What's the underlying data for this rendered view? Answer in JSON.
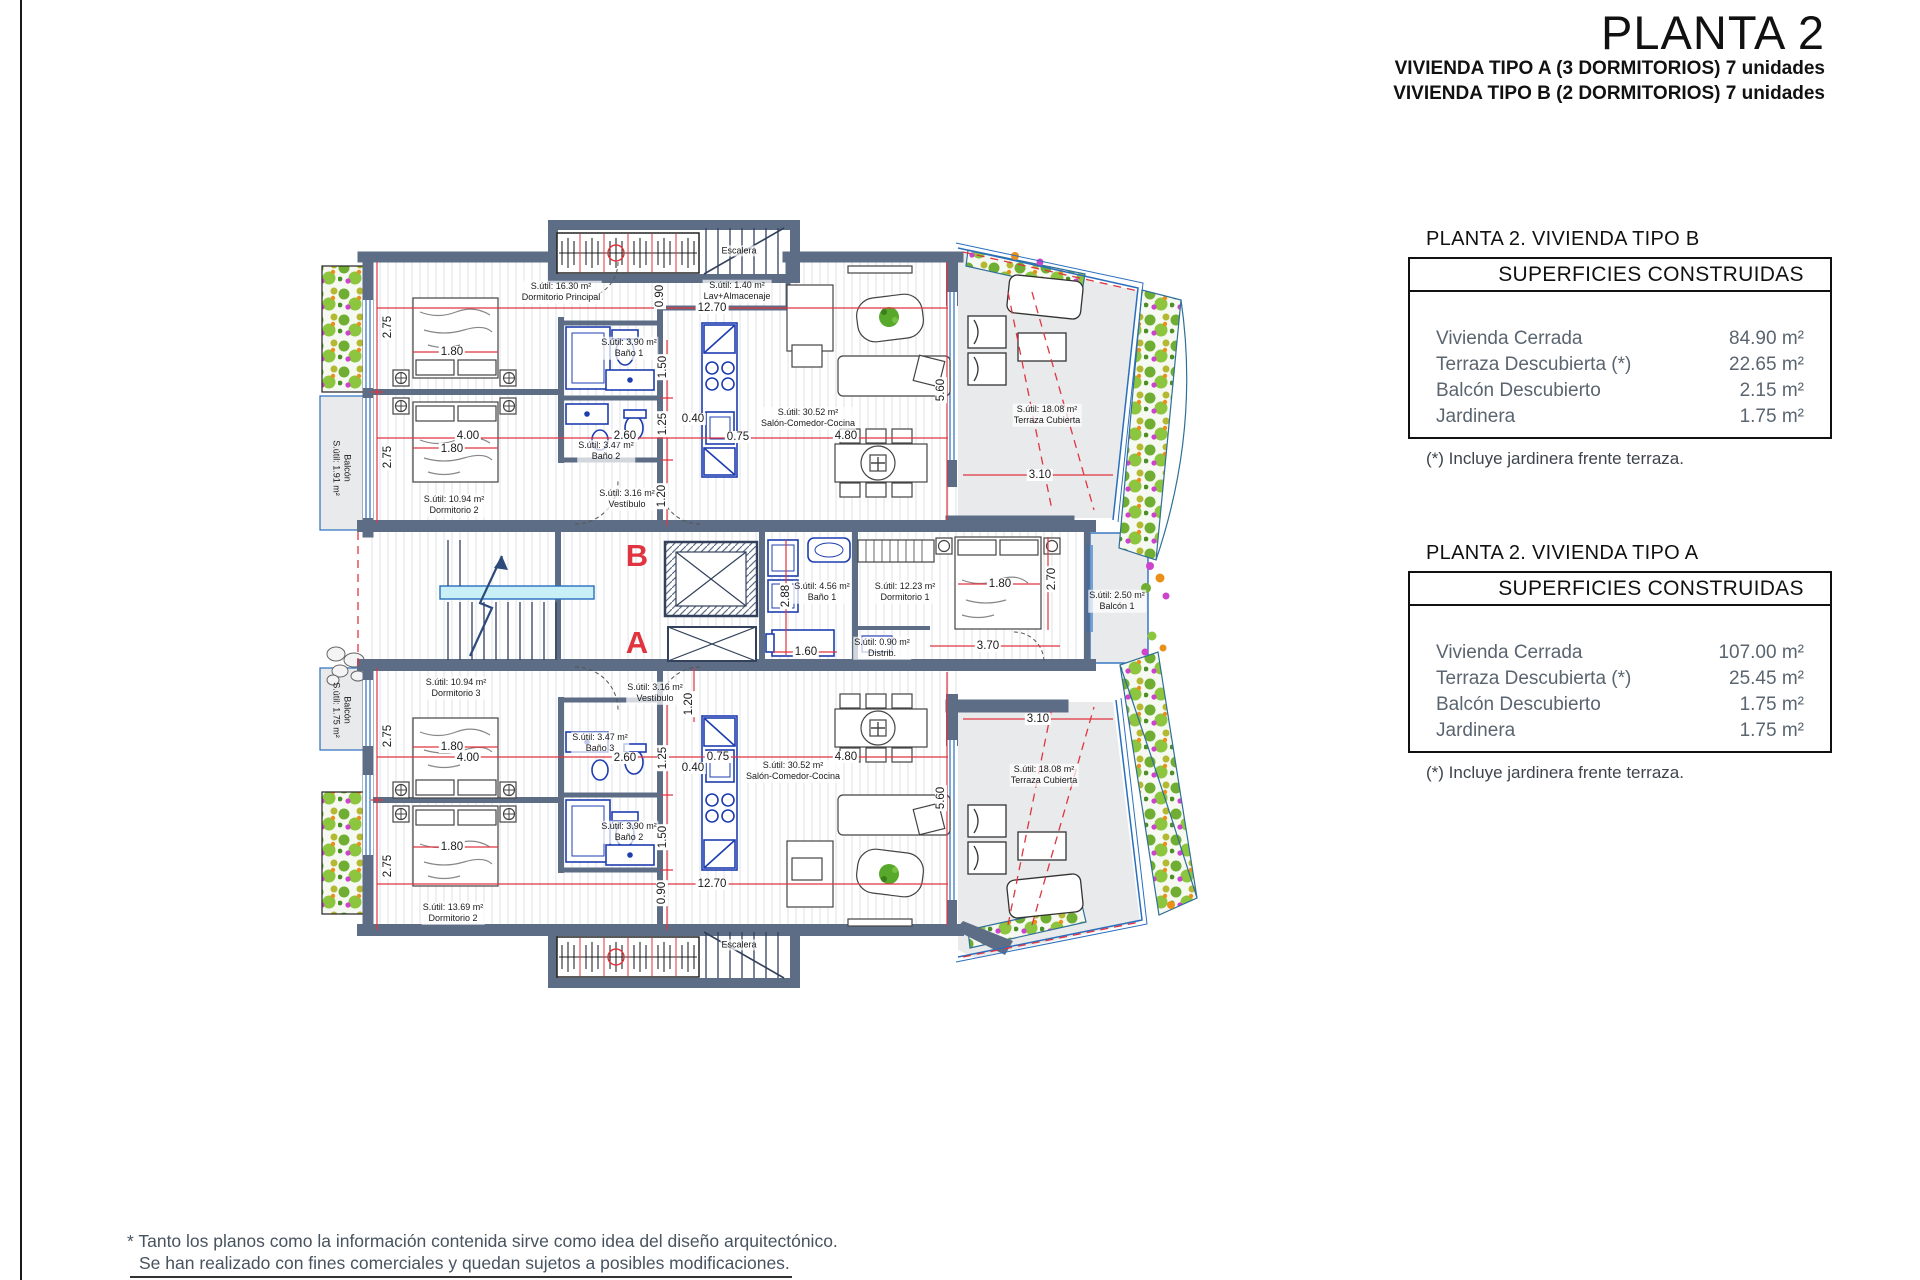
{
  "colors": {
    "wall": "#5e6d86",
    "dim_red": "#e03540",
    "fixture_blue": "#1d3db0",
    "glass_blue": "#2a6fbd",
    "terrace_gray": "#e9eaec",
    "plant_green": "#6fae32",
    "letter_red": "#e03540"
  },
  "page": {
    "title": "PLANTA 2",
    "subtitle_line1": "VIVIENDA TIPO A (3 DORMITORIOS) 7 unidades",
    "subtitle_line2": "VIVIENDA TIPO B (2 DORMITORIOS) 7 unidades",
    "disclaimer_line1": "* Tanto los planos como la información contenida sirve como idea del diseño arquitectónico.",
    "disclaimer_line2": "Se han realizado con fines comerciales y quedan sujetos a posibles modificaciones."
  },
  "panels": [
    {
      "heading": "PLANTA 2. VIVIENDA TIPO B",
      "table_title": "SUPERFICIES CONSTRUIDAS",
      "rows": [
        {
          "label": "Vivienda Cerrada",
          "value": "84.90 m²"
        },
        {
          "label": "Terraza Descubierta (*)",
          "value": "22.65 m²"
        },
        {
          "label": "Balcón Descubierto",
          "value": "2.15 m²"
        },
        {
          "label": "Jardinera",
          "value": "1.75 m²"
        }
      ],
      "footnote": "(*) Incluye jardinera frente terraza."
    },
    {
      "heading": "PLANTA 2. VIVIENDA TIPO A",
      "table_title": "SUPERFICIES CONSTRUIDAS",
      "rows": [
        {
          "label": "Vivienda Cerrada",
          "value": "107.00 m²"
        },
        {
          "label": "Terraza Descubierta (*)",
          "value": "25.45 m²"
        },
        {
          "label": "Balcón Descubierto",
          "value": "1.75 m²"
        },
        {
          "label": "Jardinera",
          "value": "1.75 m²"
        }
      ],
      "footnote": "(*) Incluye jardinera frente terraza."
    }
  ],
  "plan": {
    "unit_letters": {
      "b": {
        "t": "B",
        "x": 637,
        "y": 556
      },
      "a": {
        "t": "A",
        "x": 637,
        "y": 643
      }
    },
    "rooms": [
      {
        "id": "dormitorio-principal",
        "t": "S.útil: 16.30 m²\nDormitorio Principal",
        "x": 561,
        "y": 292
      },
      {
        "id": "lav-almacenaje",
        "t": "S.útil: 1.40 m²\nLav+Almacenaje",
        "x": 737,
        "y": 291
      },
      {
        "id": "escalera-superior",
        "t": "Escalera",
        "x": 739,
        "y": 251
      },
      {
        "id": "bano1-b",
        "t": "S.útil: 3.90 m²\nBaño 1",
        "x": 629,
        "y": 348
      },
      {
        "id": "bano2-b",
        "t": "S.útil: 3.47 m²\nBaño 2",
        "x": 606,
        "y": 451
      },
      {
        "id": "dormitorio2-b",
        "t": "S.útil: 10.94 m²\nDormitorio 2",
        "x": 454,
        "y": 505
      },
      {
        "id": "vestibulo-b",
        "t": "S.útil: 3.16 m²\nVestíbulo",
        "x": 627,
        "y": 499
      },
      {
        "id": "salon-b",
        "t": "S.útil: 30.52 m²\nSalón-Comedor-Cocina",
        "x": 808,
        "y": 418
      },
      {
        "id": "terraza-b",
        "t": "S.útil: 18.08 m²\nTerraza Cubierta",
        "x": 1047,
        "y": 415
      },
      {
        "id": "balcon-b",
        "t": "Balcón\nS.útil: 1.91 m²",
        "x": 341,
        "y": 468,
        "r": 1
      },
      {
        "id": "bano1-mid",
        "t": "S.útil: 4.56 m²\nBaño 1",
        "x": 822,
        "y": 592
      },
      {
        "id": "dormitorio1-a",
        "t": "S.útil: 12.23 m²\nDormitorio 1",
        "x": 905,
        "y": 592
      },
      {
        "id": "distribuidor",
        "t": "S.útil: 0.90 m²\nDistrib.",
        "x": 882,
        "y": 648
      },
      {
        "id": "balcon1-a",
        "t": "S.útil: 2.50 m²\nBalcón 1",
        "x": 1117,
        "y": 601
      },
      {
        "id": "vestibulo-a",
        "t": "S.útil: 3.16 m²\nVestíbulo",
        "x": 655,
        "y": 693
      },
      {
        "id": "dormitorio3-a",
        "t": "S.útil: 10.94 m²\nDormitorio 3",
        "x": 456,
        "y": 688
      },
      {
        "id": "bano3-a",
        "t": "S.útil: 3.47 m²\nBaño 3",
        "x": 600,
        "y": 743
      },
      {
        "id": "bano2-a",
        "t": "S.útil: 3.90 m²\nBaño 2",
        "x": 629,
        "y": 832
      },
      {
        "id": "dormitorio2-a",
        "t": "S.útil: 13.69 m²\nDormitorio 2",
        "x": 453,
        "y": 913
      },
      {
        "id": "salon-a",
        "t": "S.útil: 30.52 m²\nSalón-Comedor-Cocina",
        "x": 793,
        "y": 771
      },
      {
        "id": "terraza-a",
        "t": "S.útil: 18.08 m²\nTerraza Cubierta",
        "x": 1044,
        "y": 775
      },
      {
        "id": "balcon-a",
        "t": "Balcón\nS.útil: 1.75 m²",
        "x": 341,
        "y": 710,
        "r": 1
      },
      {
        "id": "escalera-inferior",
        "t": "Escalera",
        "x": 739,
        "y": 945
      }
    ],
    "dimensions": [
      {
        "t": "2.75",
        "x": 388,
        "y": 327,
        "r": 1
      },
      {
        "t": "1.80",
        "x": 452,
        "y": 352
      },
      {
        "t": "4.00",
        "x": 468,
        "y": 436
      },
      {
        "t": "1.80",
        "x": 452,
        "y": 449
      },
      {
        "t": "2.75",
        "x": 388,
        "y": 457,
        "r": 1
      },
      {
        "t": "2.60",
        "x": 625,
        "y": 436
      },
      {
        "t": "1.50",
        "x": 663,
        "y": 367,
        "r": 1
      },
      {
        "t": "1.25",
        "x": 663,
        "y": 424,
        "r": 1
      },
      {
        "t": "1.20",
        "x": 662,
        "y": 496,
        "r": 1
      },
      {
        "t": "0.90",
        "x": 660,
        "y": 296,
        "r": 1
      },
      {
        "t": "12.70",
        "x": 712,
        "y": 308
      },
      {
        "t": "0.40",
        "x": 693,
        "y": 419
      },
      {
        "t": "0.75",
        "x": 738,
        "y": 437
      },
      {
        "t": "5.60",
        "x": 941,
        "y": 390,
        "r": 1
      },
      {
        "t": "4.80",
        "x": 846,
        "y": 436
      },
      {
        "t": "3.10",
        "x": 1040,
        "y": 475
      },
      {
        "t": "2.88",
        "x": 786,
        "y": 596,
        "r": 1
      },
      {
        "t": "1.60",
        "x": 806,
        "y": 652
      },
      {
        "t": "1.80",
        "x": 1000,
        "y": 584
      },
      {
        "t": "2.70",
        "x": 1052,
        "y": 579,
        "r": 1
      },
      {
        "t": "3.70",
        "x": 988,
        "y": 646
      },
      {
        "t": "2.75",
        "x": 388,
        "y": 736,
        "r": 1
      },
      {
        "t": "1.80",
        "x": 452,
        "y": 747
      },
      {
        "t": "4.00",
        "x": 468,
        "y": 758
      },
      {
        "t": "2.60",
        "x": 625,
        "y": 758
      },
      {
        "t": "0.75",
        "x": 718,
        "y": 757
      },
      {
        "t": "0.40",
        "x": 693,
        "y": 768
      },
      {
        "t": "4.80",
        "x": 846,
        "y": 757
      },
      {
        "t": "1.25",
        "x": 663,
        "y": 758,
        "r": 1
      },
      {
        "t": "1.50",
        "x": 663,
        "y": 837,
        "r": 1
      },
      {
        "t": "1.80",
        "x": 452,
        "y": 847
      },
      {
        "t": "2.75",
        "x": 388,
        "y": 866,
        "r": 1
      },
      {
        "t": "0.90",
        "x": 662,
        "y": 893,
        "r": 1
      },
      {
        "t": "1.20",
        "x": 689,
        "y": 704,
        "r": 1
      },
      {
        "t": "12.70",
        "x": 712,
        "y": 884
      },
      {
        "t": "5.60",
        "x": 941,
        "y": 798,
        "r": 1
      },
      {
        "t": "3.10",
        "x": 1038,
        "y": 719
      }
    ]
  }
}
